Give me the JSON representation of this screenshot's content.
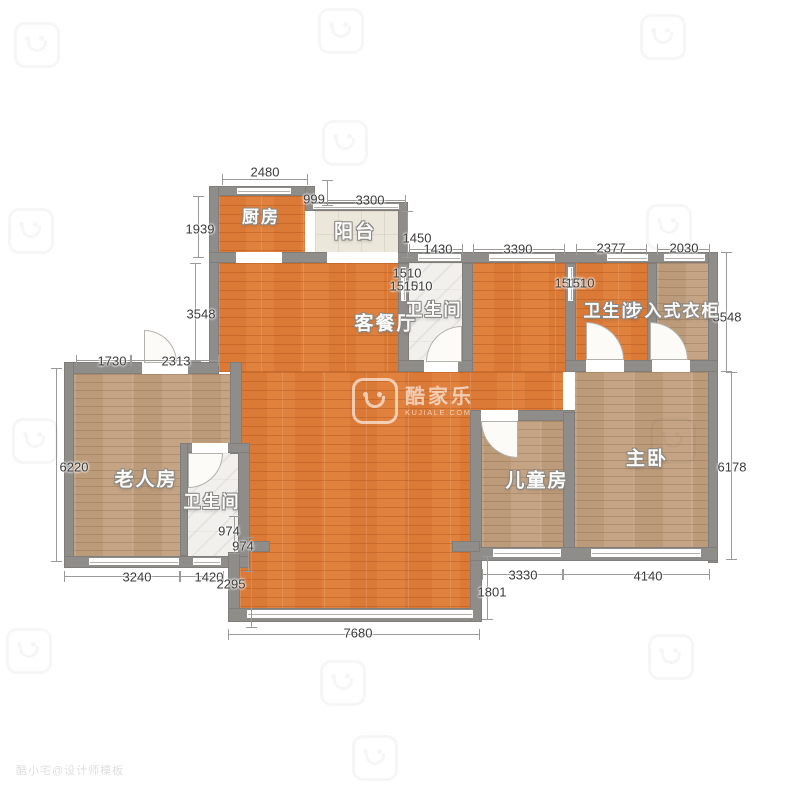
{
  "rooms": {
    "kitchen": "厨房",
    "balcony": "阳台",
    "living": "客餐厅",
    "bath_center": "卫生间",
    "bath_right": "卫生间",
    "closet": "步入式衣柜",
    "master": "主卧",
    "kids": "儿童房",
    "elder": "老人房",
    "bath_left": "卫生间"
  },
  "dims": {
    "d2480": "2480",
    "d1939": "1939",
    "d999": "999",
    "d3300": "3300",
    "d1450": "1450",
    "d1430": "1430",
    "d3390": "3390",
    "d2377": "2377",
    "d2030": "2030",
    "d3548l": "3548",
    "d3548r": "3548",
    "d1510a": "1510",
    "d1510b": "1510",
    "d1510c": "1510",
    "d1510d": "1510",
    "d1510e": "1510",
    "d1730": "1730",
    "d2313": "2313",
    "d6220": "6220",
    "d974a": "974",
    "d974b": "974",
    "d3240": "3240",
    "d1420": "1420",
    "d2295": "2295",
    "d7680": "7680",
    "d1801": "1801",
    "d3330": "3330",
    "d4140": "4140",
    "d6178": "6178"
  },
  "watermark": {
    "brand": "酷家乐",
    "site": "KUJIALE.COM",
    "designer": "酷小宅@设计师模板"
  },
  "colors": {
    "wall": "#8f8d8a",
    "wood_orange": "#e0813e",
    "wood_tan": "#c4a484",
    "balcony_tile": "#ebe7da",
    "bath_tile": "#f1f0ed",
    "dim_text": "#3b3b3b"
  }
}
